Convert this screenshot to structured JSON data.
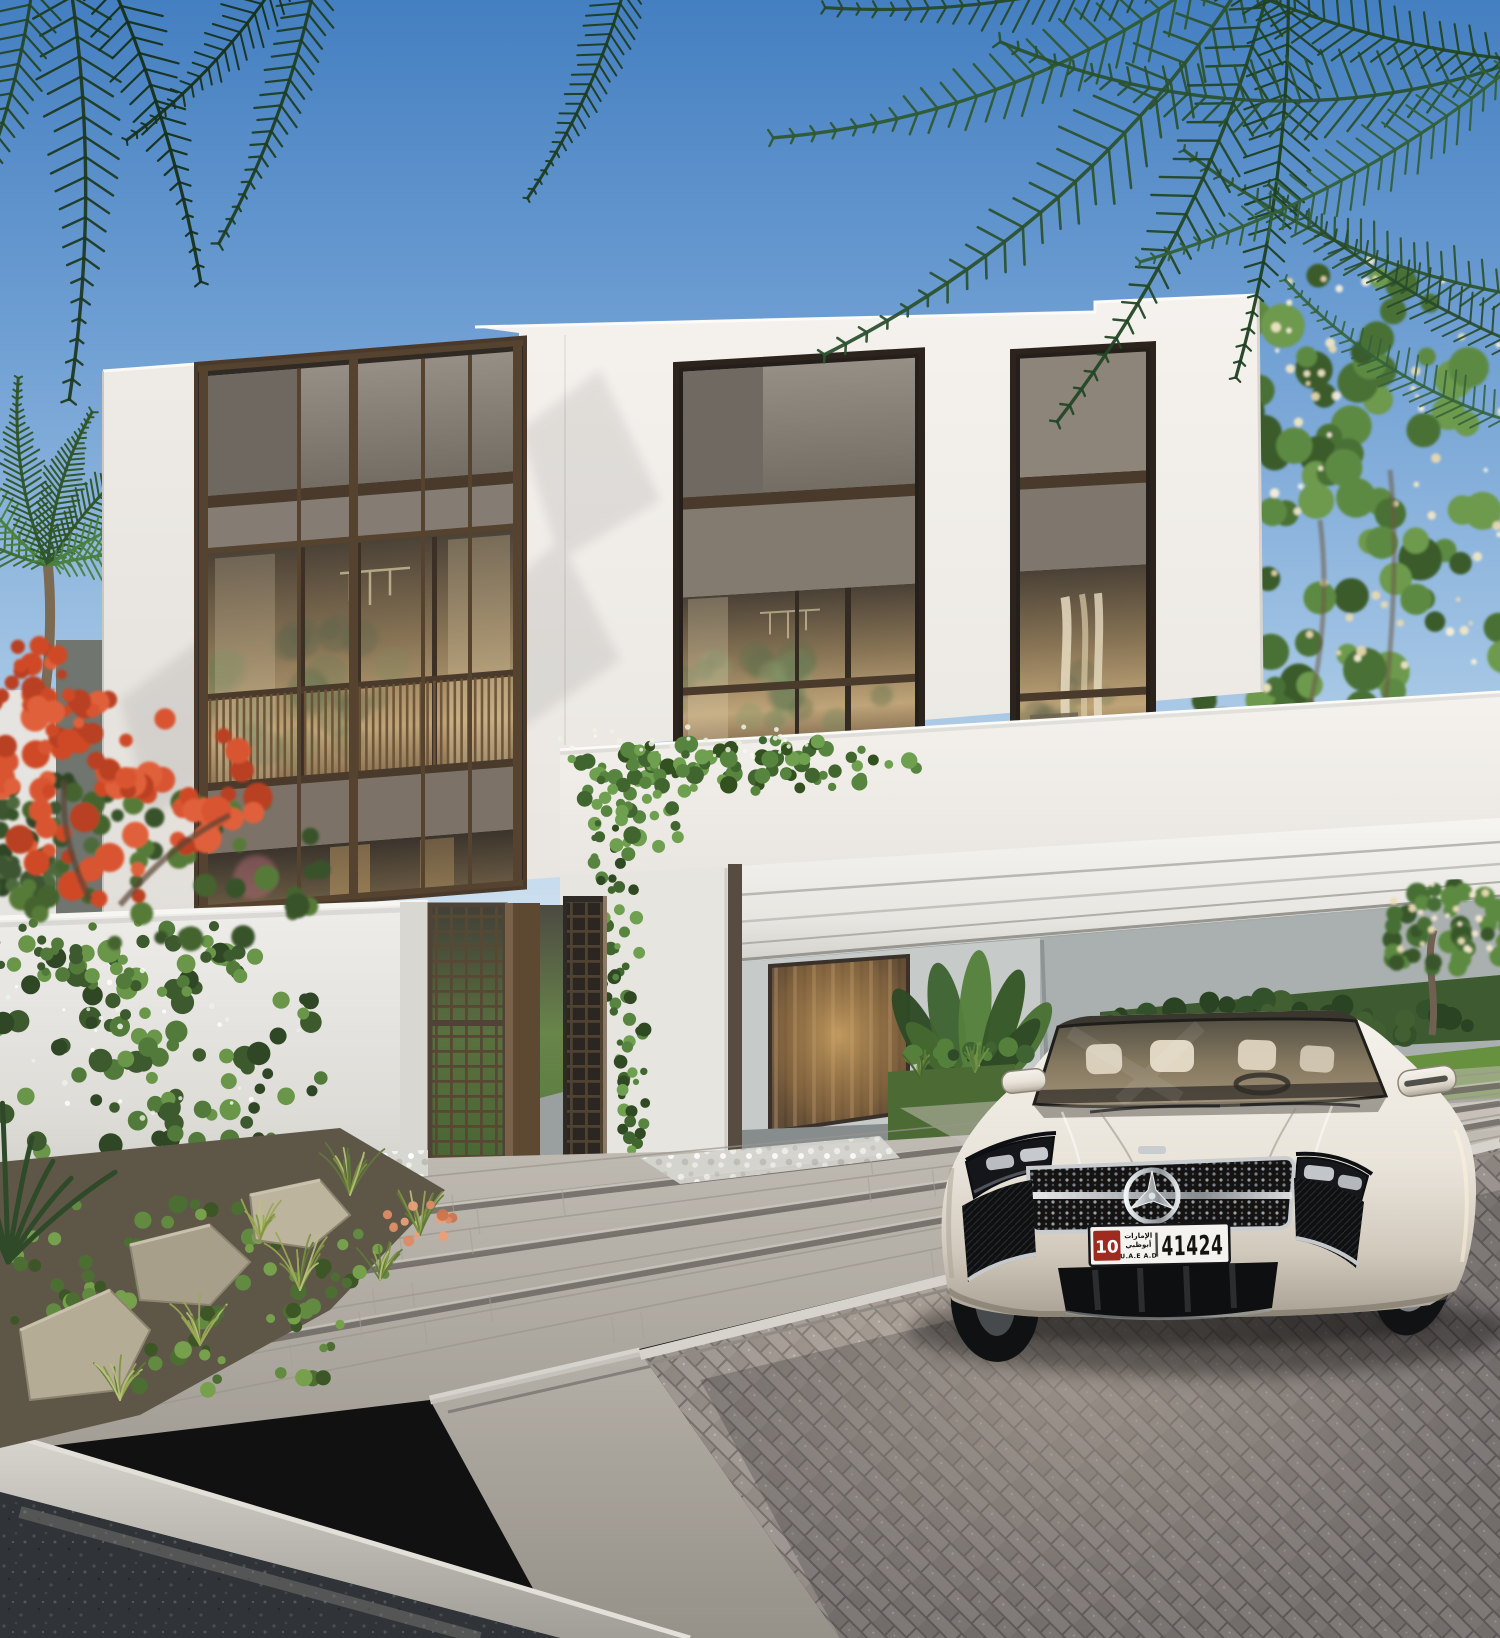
{
  "license_plate": {
    "badge": "10",
    "arabic_line1": "الإمارات",
    "arabic_line2": "أبوظبي",
    "region": "U.A.E A.D",
    "number": "41424"
  },
  "palette": {
    "sky_top": "#4a82c2",
    "sky_horizon": "#dbe9f4",
    "wall_white": "#f2efea",
    "wall_shade": "#e0ddd8",
    "bronze": "#6a5440",
    "bronze_dark": "#493a2b",
    "panel_grey": "#8c857c",
    "glass_warm": "#b6986c",
    "foliage_dark": "#24421f",
    "foliage_mid": "#4c7338",
    "foliage_light": "#6d9a4e",
    "flame_red": "#d24e2a",
    "albizia_flower": "#f2e7c4",
    "plank_paving": "#b5b0a8",
    "brick_paving": "#938b87",
    "asphalt": "#2e3134",
    "curb": "#c9c6bf",
    "car_pearl": "#e9e4da",
    "grille_black": "#141311",
    "chrome": "#c9cdd0",
    "plate_white": "#f4f3ef",
    "plate_red": "#9e2a20",
    "plate_text": "#15140f",
    "interior_grey": "#9aa0a1",
    "lawn_green": "#67913f"
  }
}
